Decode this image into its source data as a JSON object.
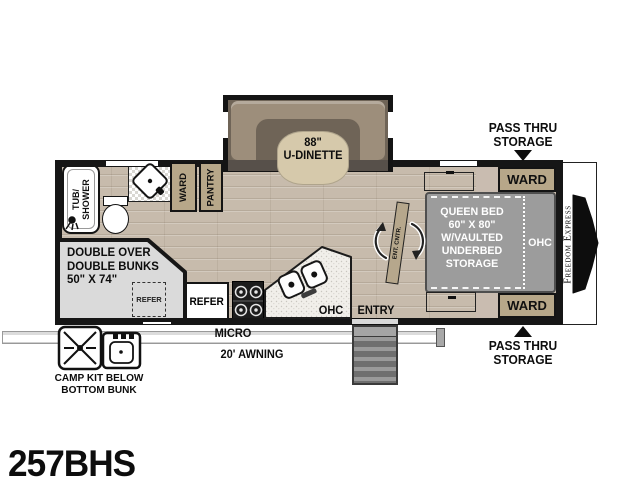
{
  "model": "257BHS",
  "brand": "Freedom Express",
  "palette": {
    "wall": "#161616",
    "cabinet_tan": "#b7a789",
    "bed_gray": "#9c9c9c",
    "bunk_gray": "#dadada",
    "floor_wood": "#c7bbac"
  },
  "dinette": {
    "line1": "88\"",
    "line2": "U-DINETTE"
  },
  "bedroom": {
    "line1": "QUEEN BED",
    "line2": "60\" X 80\"",
    "line3": "W/VAULTED",
    "line4": "UNDERBED",
    "line5": "STORAGE",
    "ohc": "OHC",
    "ward_top": "WARD",
    "ward_bottom": "WARD"
  },
  "storage": {
    "ward": "WARD",
    "pantry": "PANTRY",
    "pass_thru_top": {
      "line1": "PASS THRU",
      "line2": "STORAGE"
    },
    "pass_thru_bottom": {
      "line1": "PASS THRU",
      "line2": "STORAGE"
    }
  },
  "bath": {
    "tub_line1": "TUB/",
    "tub_line2": "SHOWER"
  },
  "bunks": {
    "line1": "DOUBLE OVER",
    "line2": "DOUBLE BUNKS",
    "line3": "50\" X 74\"",
    "refer": "REFER"
  },
  "kitchen": {
    "refer": "REFER",
    "micro": "MICRO",
    "ohc": "OHC"
  },
  "exterior": {
    "awning": "20' AWNING",
    "entry": "ENTRY",
    "camp_line1": "CAMP KIT BELOW",
    "camp_line2": "BOTTOM BUNK"
  },
  "entertainment": {
    "label": "ENT. CNTR."
  }
}
